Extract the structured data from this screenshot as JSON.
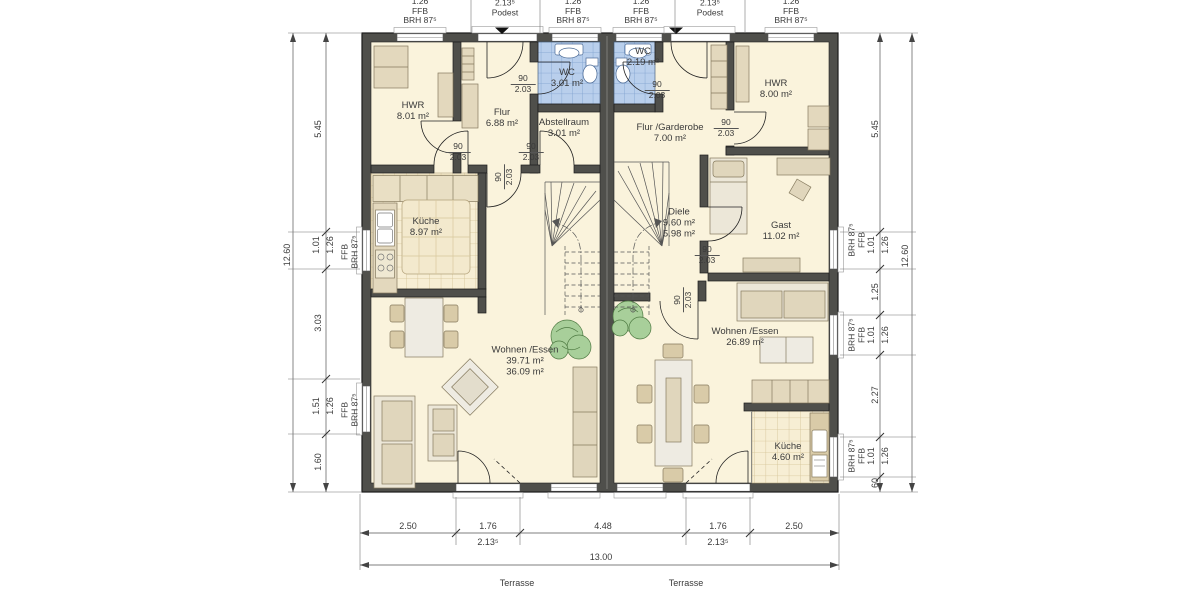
{
  "plan": {
    "rooms_left": [
      {
        "name": "HWR",
        "area": "8.01 m²"
      },
      {
        "name": "Flur",
        "area": "6.88 m²"
      },
      {
        "name": "WC",
        "area": "3.01 m²"
      },
      {
        "name": "Abstellraum",
        "area": "3.01 m²"
      },
      {
        "name": "Küche",
        "area": "8.97 m²"
      },
      {
        "name": "Wohnen /Essen",
        "area": "39.71 m²",
        "area2": "36.09 m²"
      }
    ],
    "rooms_right": [
      {
        "name": "WC",
        "area": "2.19 m²"
      },
      {
        "name": "Flur /Garderobe",
        "area": "7.00 m²"
      },
      {
        "name": "HWR",
        "area": "8.00 m²"
      },
      {
        "name": "Diele",
        "area": "9.60 m²",
        "area2": "5.98 m²"
      },
      {
        "name": "Gast",
        "area": "11.02 m²"
      },
      {
        "name": "Wohnen /Essen",
        "area": "26.89 m²"
      },
      {
        "name": "Küche",
        "area": "4.60 m²"
      }
    ]
  },
  "door_labels": [
    {
      "w": "90",
      "h": "2.03"
    },
    {
      "w": "90",
      "h": "2.03"
    },
    {
      "w": "90",
      "h": "2.03"
    },
    {
      "w": "90",
      "h": "2.03"
    },
    {
      "w": "90",
      "h": "2.03"
    },
    {
      "w": "90",
      "h": "2.03"
    },
    {
      "w": "90",
      "h": "2.03"
    },
    {
      "w": "90",
      "h": "2.03"
    }
  ],
  "dims": {
    "top": [
      {
        "v": "1.26",
        "n1": "FFB",
        "n2": "BRH 87⁵"
      },
      {
        "v": "2.13⁵",
        "n1": "Podest",
        "n2": ""
      },
      {
        "v": "1.26",
        "n1": "FFB",
        "n2": "BRH 87⁵"
      },
      {
        "v": "1.26",
        "n1": "FFB",
        "n2": "BRH 87⁵"
      },
      {
        "v": "2.13⁵",
        "n1": "Podest",
        "n2": ""
      },
      {
        "v": "1.26",
        "n1": "FFB",
        "n2": "BRH 87⁵"
      }
    ],
    "left": {
      "total": "12.60",
      "segments": [
        "5.45",
        "1.01",
        "3.03",
        "1.51",
        "1.60"
      ],
      "win": [
        {
          "v": "1.26",
          "n1": "FFB",
          "n2": "BRH 87⁵"
        },
        {
          "v": "1.26",
          "n1": "FFB",
          "n2": "BRH 87⁵"
        }
      ]
    },
    "right": {
      "total": "12.60",
      "segments": [
        "5.45",
        "1.01",
        "1.25",
        "1.01",
        "2.27",
        "1.01",
        "60"
      ],
      "win": [
        {
          "v": "1.26",
          "n1": "BRH 87⁵",
          "n2": "FFB"
        },
        {
          "v": "1.26",
          "n1": "BRH 87⁵",
          "n2": "FFB"
        },
        {
          "v": "1.26",
          "n1": "BRH 87⁵",
          "n2": "FFB"
        }
      ]
    },
    "bottom": {
      "total": "13.00",
      "segments": [
        "2.50",
        "1.76",
        "4.48",
        "1.76",
        "2.50"
      ],
      "doors": [
        "2.13⁵",
        "2.13⁵"
      ]
    }
  },
  "labels": {
    "terrasse": [
      "Terrasse",
      "Terrasse"
    ]
  },
  "colors": {
    "wall": "#4f4f4b",
    "room": "#faf3dc",
    "wc_tile": "#b9cfec",
    "kitchen_tile": "#f7eed4",
    "furniture": "#e3d8bd",
    "plant": "#a8cf9a"
  }
}
